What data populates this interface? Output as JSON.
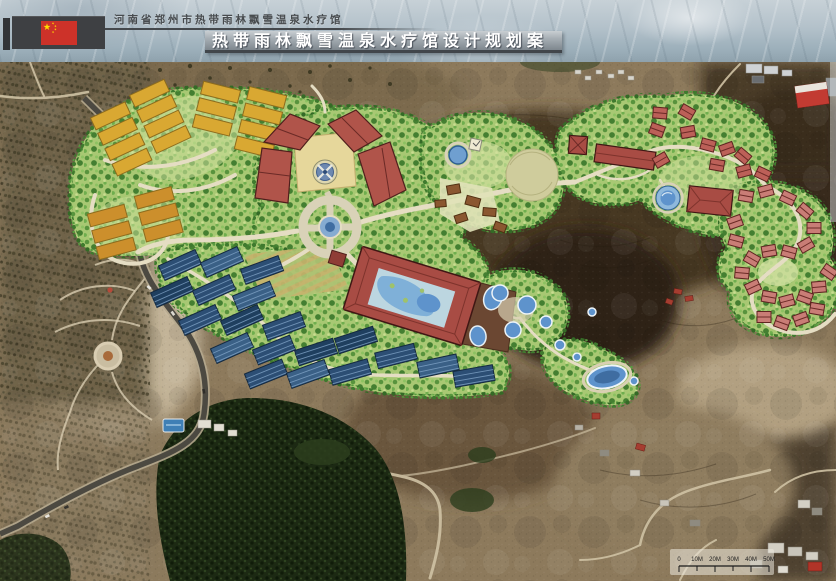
{
  "header": {
    "region_title": "河南省郑州市热带雨林飘雪温泉水疗馆",
    "main_title": "热带雨林飘雪温泉水疗馆设计规划案"
  },
  "map": {
    "scale_bar": {
      "labels": [
        "0",
        "10M",
        "20M",
        "30M",
        "40M",
        "50M"
      ]
    }
  },
  "colors": {
    "flag_red": "#cd3229",
    "flag_yellow": "#ffde00",
    "header_block": "#3e4043",
    "title_band_text": "#ffffff",
    "plan_green": "#a8c873",
    "roof_red": "#a84c44",
    "pool_blue": "#5e93cc",
    "cabin_blue": "#2c4e74",
    "garden_bed_yellow": "#d9a832",
    "terrain_brown": "#8d7a5c",
    "forest_green": "#1c2913"
  }
}
